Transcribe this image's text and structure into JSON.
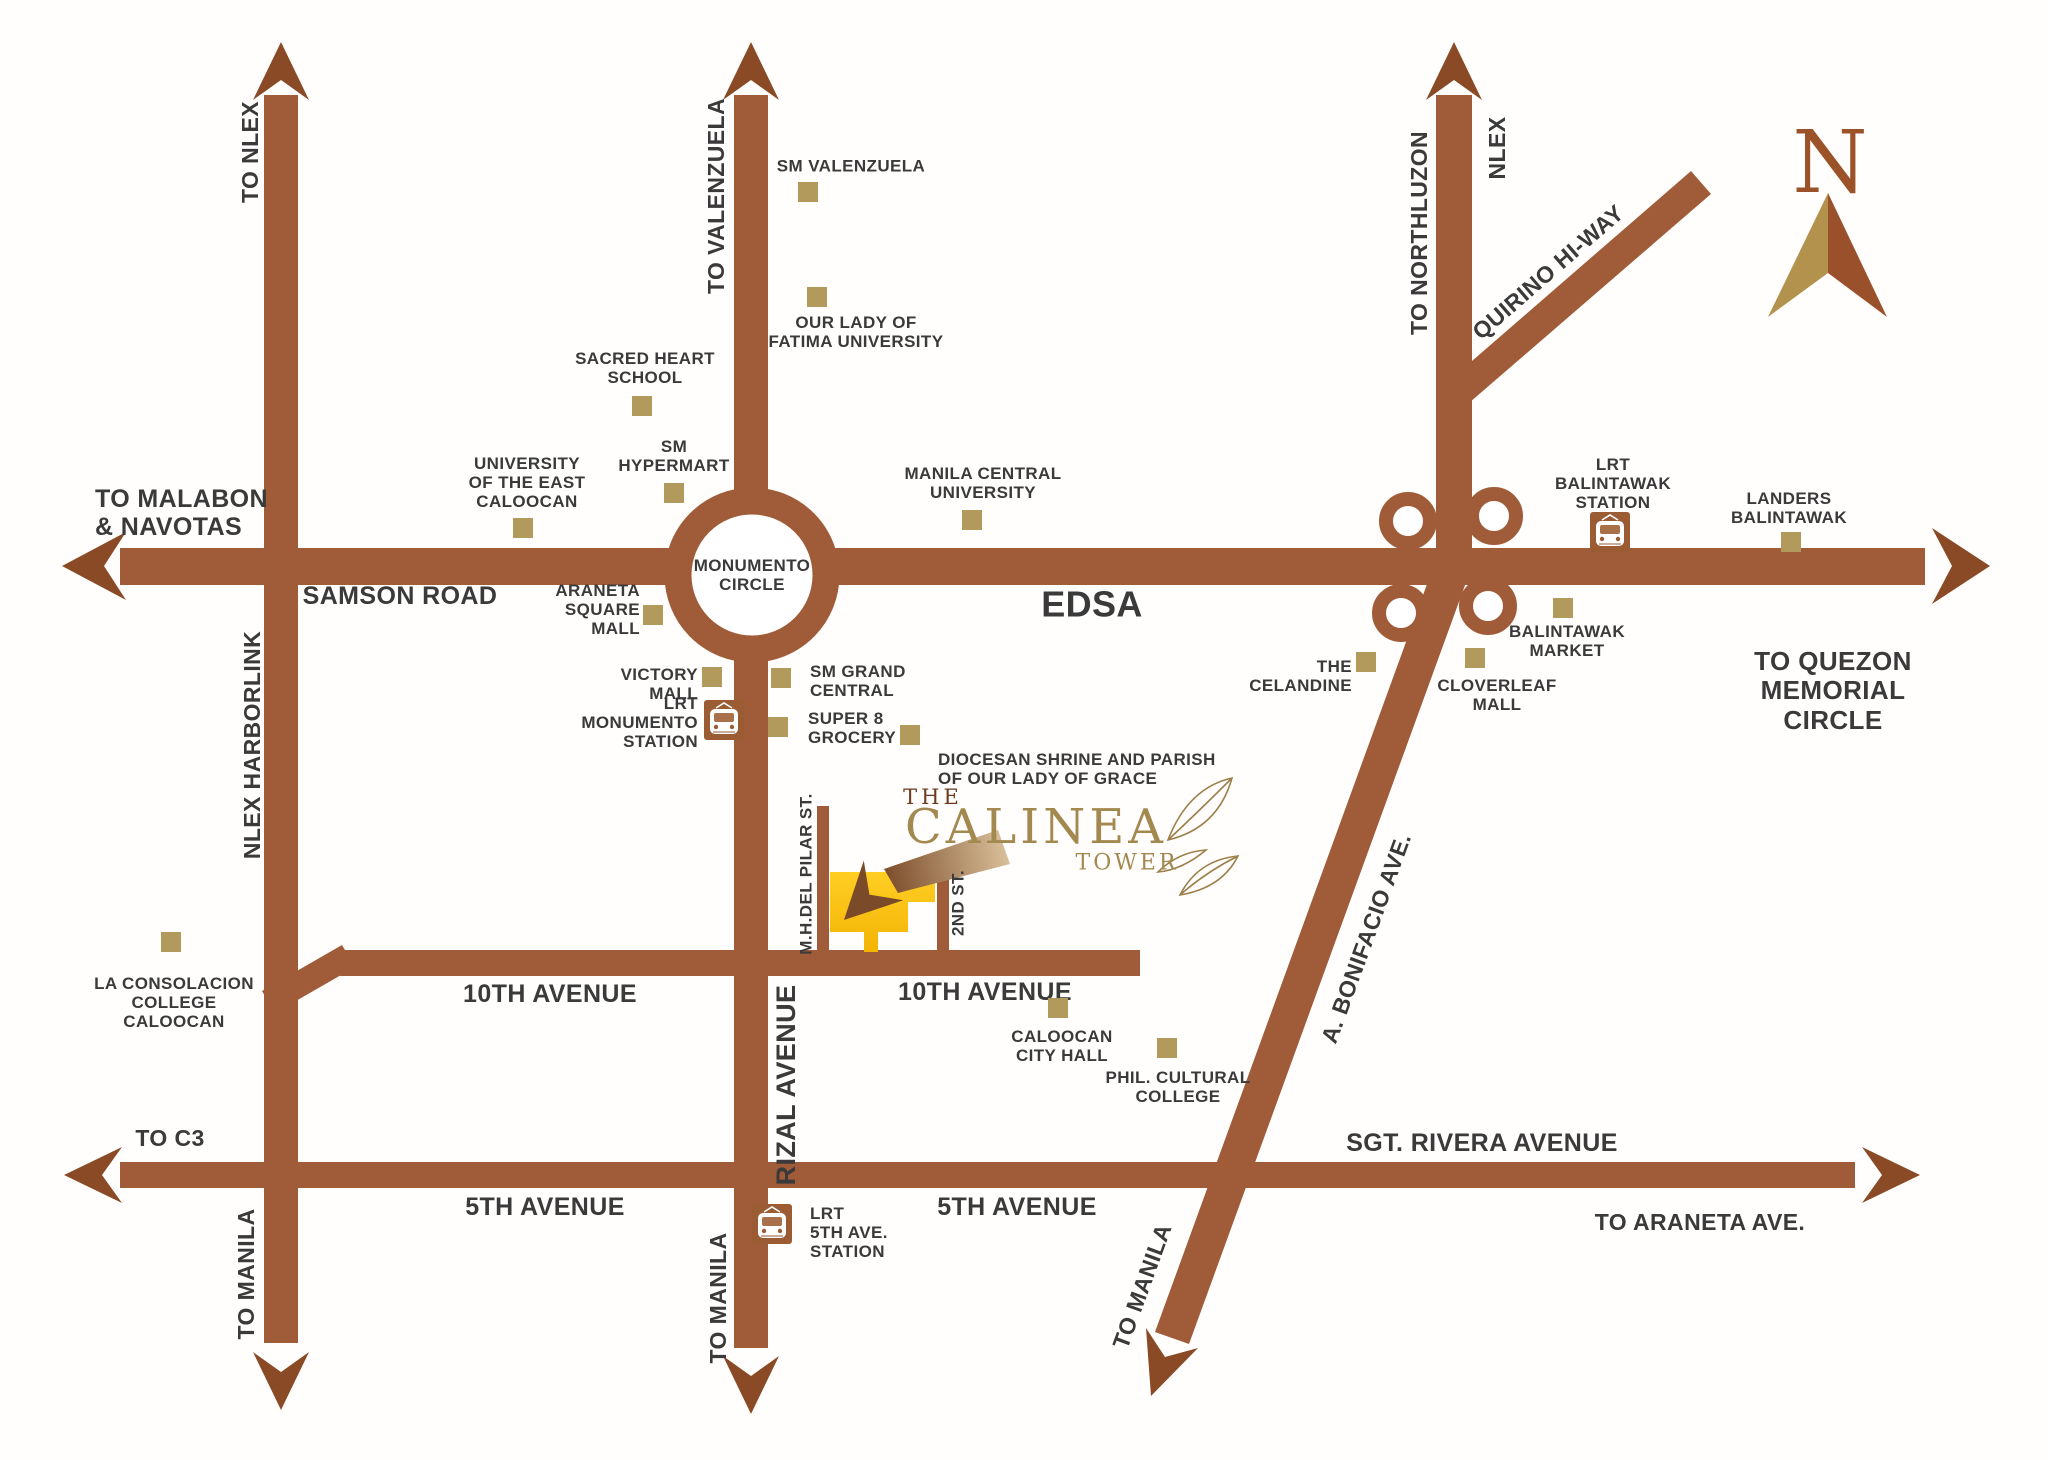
{
  "colors": {
    "road": "#a05c38",
    "arrowhead": "#8a4a26",
    "poi_marker": "#b29a5c",
    "label_text": "#3a3a3a",
    "logo_gold": "#a3894f",
    "logo_brown": "#6c3a1f",
    "building_yellow": "#ffc513",
    "compass_left": "#b3924e",
    "compass_right": "#9a512b"
  },
  "logo": {
    "the": "THE",
    "name": "CALINEA",
    "tower": "TOWER"
  },
  "compass": {
    "letter": "N"
  },
  "road_labels": [
    {
      "id": "to-nlex",
      "text": "TO NLEX",
      "x": 250,
      "y": 152,
      "fs": 23,
      "rot": -90
    },
    {
      "id": "to-valenzuela",
      "text": "TO VALENZUELA",
      "x": 716,
      "y": 196,
      "fs": 23,
      "rot": -90
    },
    {
      "id": "to-northluzon",
      "text": "TO NORTHLUZON",
      "x": 1419,
      "y": 233,
      "fs": 23,
      "rot": -90
    },
    {
      "id": "nlex",
      "text": "NLEX",
      "x": 1497,
      "y": 148,
      "fs": 23,
      "rot": -90
    },
    {
      "id": "quirino-hiway",
      "text": "QUIRINO HI-WAY",
      "x": 1548,
      "y": 272,
      "fs": 23,
      "rot": -41
    },
    {
      "id": "to-malabon-navotas",
      "text": "TO MALABON\n& NAVOTAS",
      "x": 95,
      "y": 513,
      "fs": 25,
      "align": "left"
    },
    {
      "id": "samson-road",
      "text": "SAMSON ROAD",
      "x": 400,
      "y": 596,
      "fs": 25
    },
    {
      "id": "edsa",
      "text": "EDSA",
      "x": 1092,
      "y": 605,
      "fs": 36
    },
    {
      "id": "monumento-circle",
      "text": "MONUMENTO\nCIRCLE",
      "x": 752,
      "y": 575,
      "fs": 17
    },
    {
      "id": "to-quezon-memorial-circle",
      "text": "TO QUEZON\nMEMORIAL\nCIRCLE",
      "x": 1833,
      "y": 691,
      "fs": 26
    },
    {
      "id": "nlex-harborlink",
      "text": "NLEX HARBORLINK",
      "x": 252,
      "y": 745,
      "fs": 23,
      "rot": -90
    },
    {
      "id": "rizal-avenue",
      "text": "RIZAL AVENUE",
      "x": 786,
      "y": 1085,
      "fs": 27,
      "rot": -90
    },
    {
      "id": "10th-avenue-west",
      "text": "10TH AVENUE",
      "x": 550,
      "y": 994,
      "fs": 25
    },
    {
      "id": "10th-avenue-east",
      "text": "10TH AVENUE",
      "x": 985,
      "y": 992,
      "fs": 25
    },
    {
      "id": "5th-avenue-west",
      "text": "5TH AVENUE",
      "x": 545,
      "y": 1207,
      "fs": 25
    },
    {
      "id": "5th-avenue-east",
      "text": "5TH AVENUE",
      "x": 1017,
      "y": 1207,
      "fs": 25
    },
    {
      "id": "sgt-rivera-avenue",
      "text": "SGT. RIVERA AVENUE",
      "x": 1482,
      "y": 1143,
      "fs": 25
    },
    {
      "id": "to-araneta-ave",
      "text": "TO ARANETA AVE.",
      "x": 1700,
      "y": 1222,
      "fs": 23
    },
    {
      "id": "to-c3",
      "text": "TO C3",
      "x": 170,
      "y": 1138,
      "fs": 23
    },
    {
      "id": "to-manila-harborlink",
      "text": "TO MANILA",
      "x": 246,
      "y": 1274,
      "fs": 23,
      "rot": -90
    },
    {
      "id": "to-manila-rizal",
      "text": "TO MANILA",
      "x": 718,
      "y": 1298,
      "fs": 23,
      "rot": -90
    },
    {
      "id": "to-manila-bonifacio",
      "text": "TO MANILA",
      "x": 1142,
      "y": 1286,
      "fs": 23,
      "rot": -70
    },
    {
      "id": "a-bonifacio-ave",
      "text": "A. BONIFACIO AVE.",
      "x": 1366,
      "y": 938,
      "fs": 23,
      "rot": -70
    },
    {
      "id": "mh-del-pilar-st",
      "text": "M.H.DEL PILAR ST.",
      "x": 806,
      "y": 874,
      "fs": 17,
      "rot": -90
    },
    {
      "id": "2nd-st",
      "text": "2ND ST.",
      "x": 958,
      "y": 903,
      "fs": 17,
      "rot": -90
    }
  ],
  "pois": [
    {
      "id": "sm-valenzuela",
      "text": "SM VALENZUELA",
      "label": {
        "x": 851,
        "y": 166
      },
      "marker": {
        "x": 798,
        "y": 182
      }
    },
    {
      "id": "our-lady-of-fatima-university",
      "text": "OUR LADY OF\nFATIMA UNIVERSITY",
      "label": {
        "x": 856,
        "y": 332
      },
      "marker": {
        "x": 807,
        "y": 287
      }
    },
    {
      "id": "sacred-heart-school",
      "text": "SACRED HEART\nSCHOOL",
      "label": {
        "x": 645,
        "y": 368
      },
      "marker": {
        "x": 632,
        "y": 396
      }
    },
    {
      "id": "sm-hypermart",
      "text": "SM\nHYPERMART",
      "label": {
        "x": 674,
        "y": 456
      },
      "marker": {
        "x": 664,
        "y": 483
      }
    },
    {
      "id": "university-of-the-east-caloocan",
      "text": "UNIVERSITY\nOF THE EAST\nCALOOCAN",
      "label": {
        "x": 527,
        "y": 483
      },
      "marker": {
        "x": 513,
        "y": 518
      }
    },
    {
      "id": "manila-central-university",
      "text": "MANILA CENTRAL\nUNIVERSITY",
      "label": {
        "x": 983,
        "y": 483
      },
      "marker": {
        "x": 962,
        "y": 510
      }
    },
    {
      "id": "araneta-square-mall",
      "text": "ARANETA\nSQUARE\nMALL",
      "label": {
        "x": 640,
        "y": 610,
        "align": "right"
      },
      "marker": {
        "x": 643,
        "y": 605
      }
    },
    {
      "id": "victory-mall",
      "text": "VICTORY\nMALL",
      "label": {
        "x": 698,
        "y": 684,
        "align": "right"
      },
      "marker": {
        "x": 702,
        "y": 667
      }
    },
    {
      "id": "sm-grand-central",
      "text": "SM GRAND\nCENTRAL",
      "label": {
        "x": 810,
        "y": 681,
        "align": "left"
      },
      "marker": {
        "x": 771,
        "y": 668
      }
    },
    {
      "id": "lrt-monumento-station",
      "text": "LRT\nMONUMENTO\nSTATION",
      "label": {
        "x": 698,
        "y": 723,
        "align": "right"
      },
      "icon": {
        "x": 704,
        "y": 700
      }
    },
    {
      "id": "super-8-grocery",
      "text": "SUPER 8\nGROCERY",
      "label": {
        "x": 808,
        "y": 728,
        "align": "left"
      },
      "marker": {
        "x": 768,
        "y": 717
      }
    },
    {
      "id": "diocesan-shrine",
      "text": "DIOCESAN SHRINE AND PARISH\nOF OUR LADY OF GRACE",
      "label": {
        "x": 938,
        "y": 769,
        "align": "left"
      },
      "marker": {
        "x": 900,
        "y": 725
      }
    },
    {
      "id": "the-celandine",
      "text": "THE\nCELANDINE",
      "label": {
        "x": 1352,
        "y": 676,
        "align": "right"
      },
      "marker": {
        "x": 1356,
        "y": 652
      }
    },
    {
      "id": "cloverleaf-mall",
      "text": "CLOVERLEAF\nMALL",
      "label": {
        "x": 1497,
        "y": 695
      },
      "marker": {
        "x": 1465,
        "y": 648
      }
    },
    {
      "id": "balintawak-market",
      "text": "BALINTAWAK\nMARKET",
      "label": {
        "x": 1567,
        "y": 641
      },
      "marker": {
        "x": 1553,
        "y": 598
      }
    },
    {
      "id": "lrt-balintawak-station",
      "text": "LRT\nBALINTAWAK\nSTATION",
      "label": {
        "x": 1613,
        "y": 484
      },
      "icon": {
        "x": 1590,
        "y": 512
      }
    },
    {
      "id": "landers-balintawak",
      "text": "LANDERS\nBALINTAWAK",
      "label": {
        "x": 1789,
        "y": 508
      },
      "marker": {
        "x": 1781,
        "y": 532
      }
    },
    {
      "id": "la-consolacion-college-caloocan",
      "text": "LA CONSOLACION\nCOLLEGE\nCALOOCAN",
      "label": {
        "x": 174,
        "y": 1003
      },
      "marker": {
        "x": 161,
        "y": 932
      }
    },
    {
      "id": "caloocan-city-hall",
      "text": "CALOOCAN\nCITY HALL",
      "label": {
        "x": 1062,
        "y": 1046
      },
      "marker": {
        "x": 1048,
        "y": 998
      }
    },
    {
      "id": "phil-cultural-college",
      "text": "PHIL. CULTURAL\nCOLLEGE",
      "label": {
        "x": 1178,
        "y": 1087
      },
      "marker": {
        "x": 1157,
        "y": 1038
      }
    },
    {
      "id": "lrt-5th-ave-station",
      "text": "LRT\n5TH AVE.\nSTATION",
      "label": {
        "x": 810,
        "y": 1233,
        "align": "left"
      },
      "icon": {
        "x": 752,
        "y": 1204
      }
    }
  ]
}
